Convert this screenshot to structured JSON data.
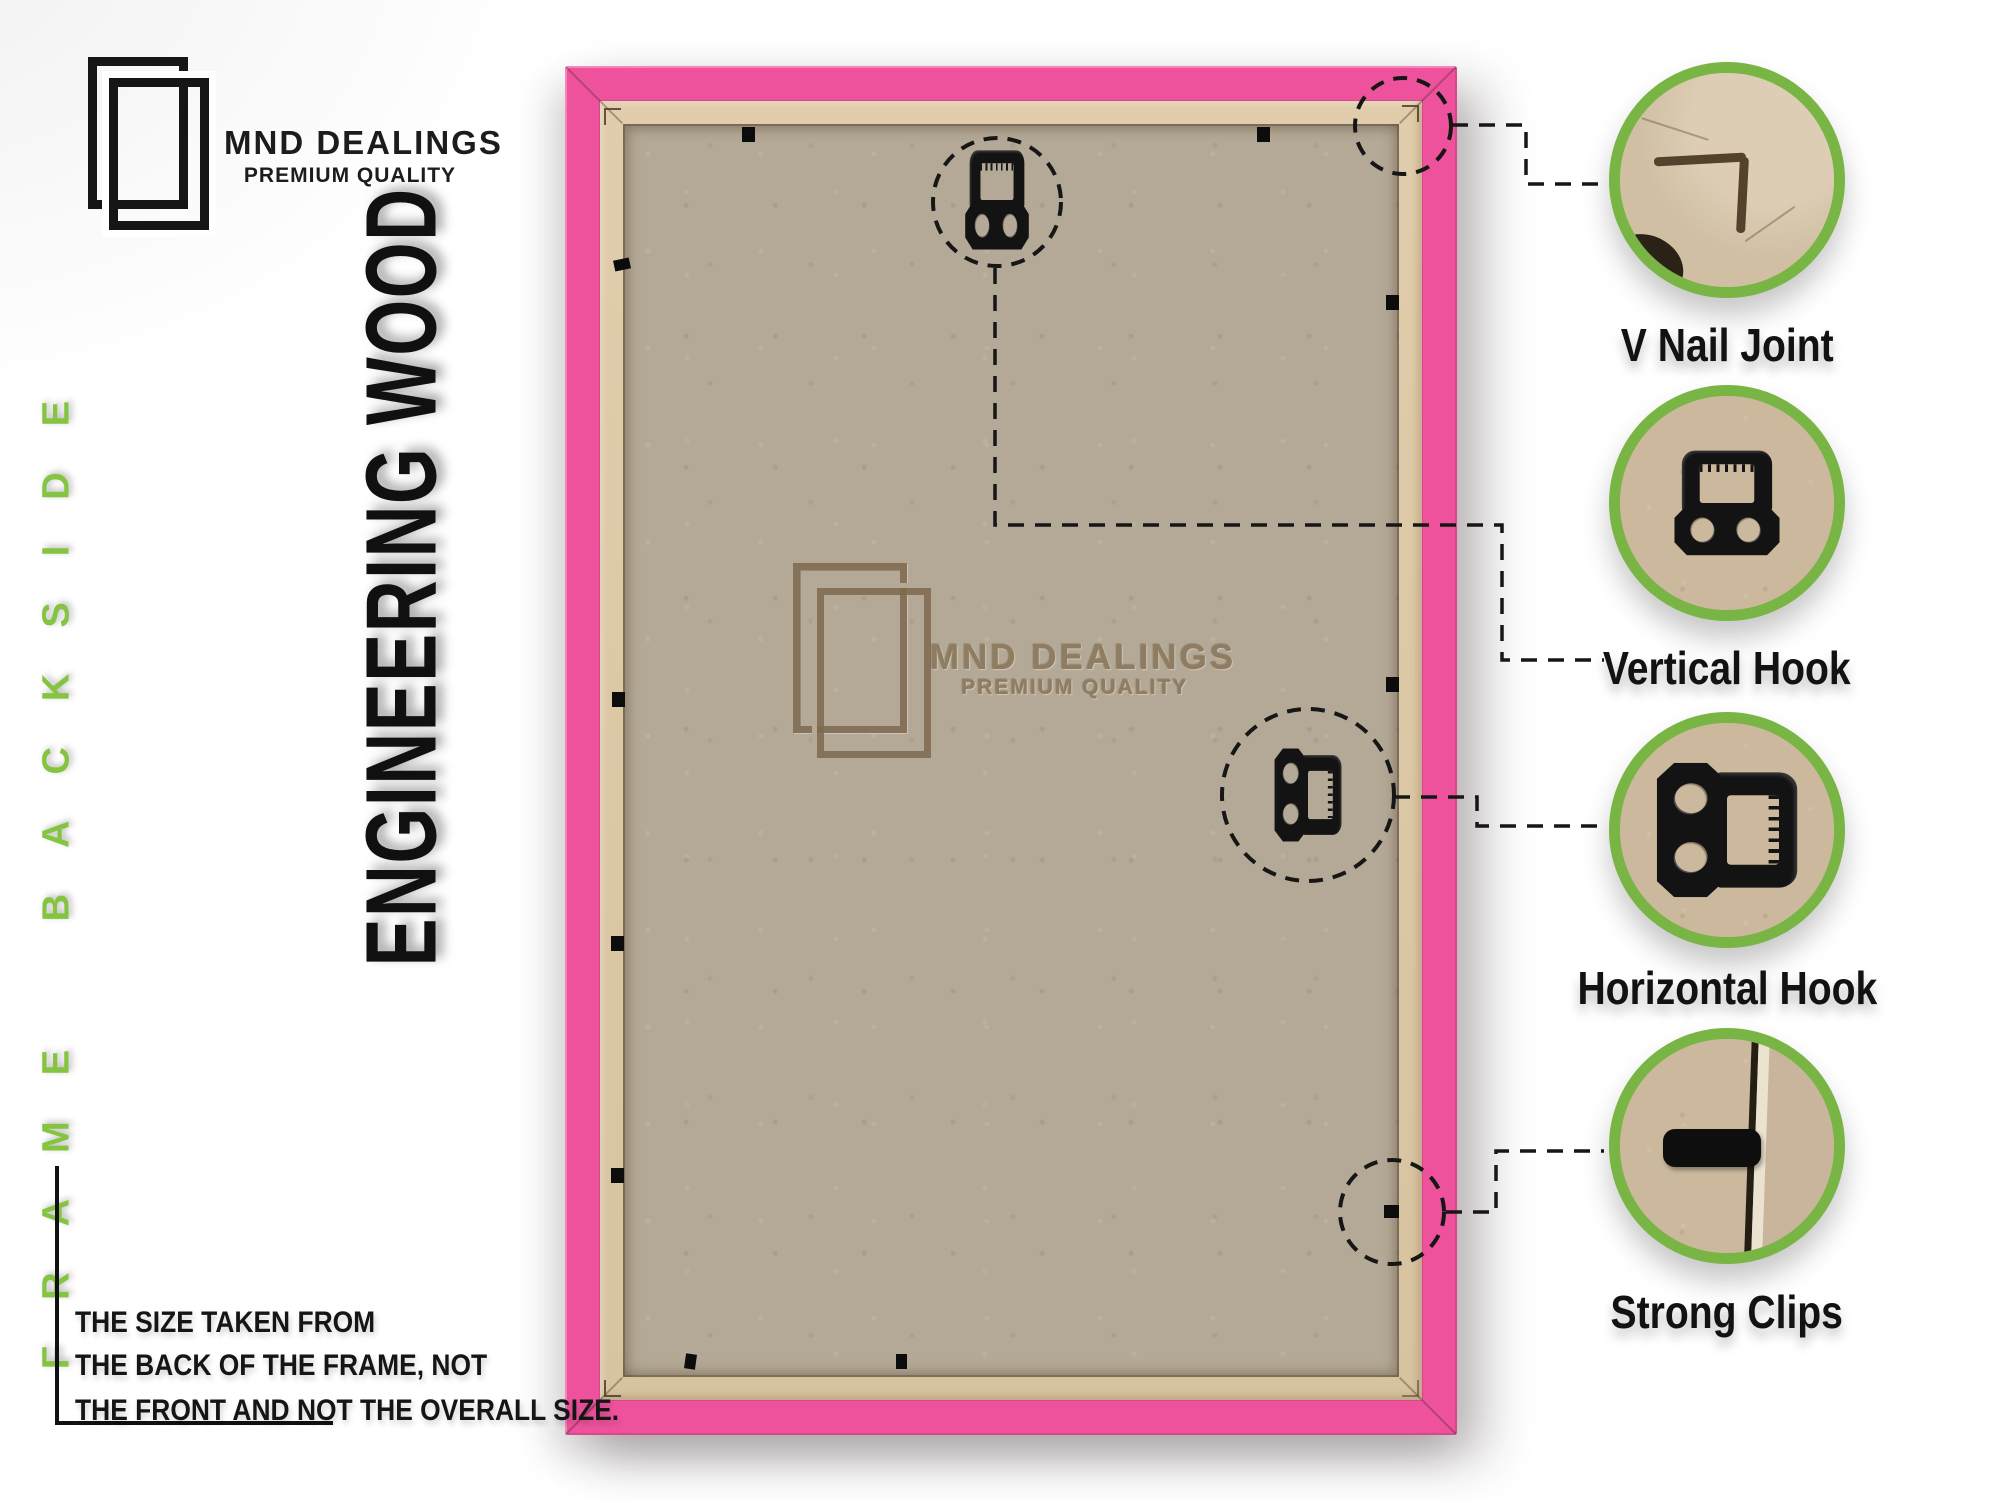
{
  "brand": {
    "name": "MND DEALINGS",
    "tagline": "PREMIUM QUALITY"
  },
  "side_label": "FRAME BACKSIDE",
  "material_label": "ENGINEERING WOOD",
  "watermark": {
    "name": "MND DEALINGS",
    "tagline": "PREMIUM QUALITY"
  },
  "callouts": [
    {
      "label": "V Nail Joint"
    },
    {
      "label": "Vertical Hook"
    },
    {
      "label": "Horizontal Hook"
    },
    {
      "label": "Strong Clips"
    }
  ],
  "note": {
    "line1": "THE SIZE TAKEN FROM",
    "line2": "THE BACK OF THE FRAME, NOT",
    "line3": "THE FRONT AND NOT THE OVERALL SIZE."
  },
  "colors": {
    "frame_pink": "#ef529d",
    "frame_lip_tan": "#dcc7a4",
    "board_tan": "#b4a996",
    "accent_green": "#79b544",
    "side_label_green": "#85c441",
    "ink": "#151515"
  }
}
